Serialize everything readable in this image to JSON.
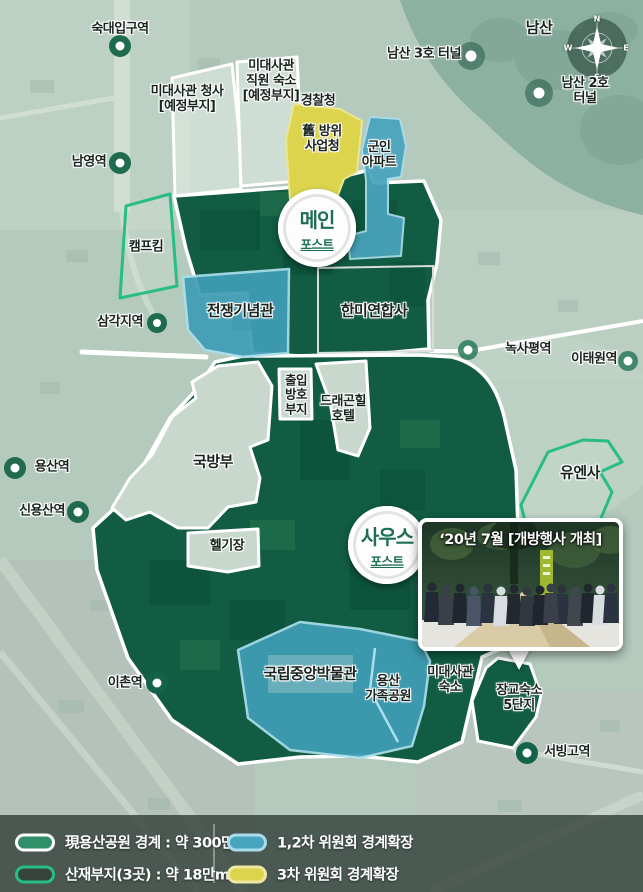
{
  "compass": {
    "n": "N",
    "e": "E",
    "s": "S",
    "w": "W"
  },
  "badges": {
    "main_line1": "메인",
    "main_line2": "포스트",
    "south_line1": "사우스",
    "south_line2": "포스트"
  },
  "stations": {
    "sookdae": "숙대입구역",
    "namyeong": "남영역",
    "samgakji": "삼각지역",
    "noksapyeong": "녹사평역",
    "itaewon": "이태원역",
    "yongsan": "용산역",
    "sinyongsan": "신용산역",
    "ichon": "이촌역",
    "seobinggo": "서빙고역"
  },
  "landmarks": {
    "namsan": "남산",
    "tunnel3": "남산 3호 터널",
    "tunnel2": "남산 2호 터널",
    "embassy_office": "미대사관 청사\n[예정부지]",
    "embassy_staff": "미대사관\n직원 숙소\n[예정부지]",
    "police": "경찰청",
    "old_dapa": "舊 방위\n사업청",
    "military_apt": "군인\n아파트",
    "camp_kim": "캠프킴",
    "war_memorial": "전쟁기념관",
    "cfc": "한미연합사",
    "access_site": "출입\n방호\n부지",
    "dragon_hill": "드래곤힐\n호텔",
    "mnd": "국방부",
    "heliport": "헬기장",
    "un_command": "유엔사",
    "museum": "국립중앙박물관",
    "family_park": "용산\n가족공원",
    "embassy_housing": "미대사관\n숙소",
    "officer_housing": "장교숙소\n5단지"
  },
  "photo": {
    "caption": "‘20년 7월 [개방행사 개최]"
  },
  "legend": {
    "items": [
      {
        "label": "現용산공원 경계 : 약 300만m²"
      },
      {
        "label": "산재부지(3곳) : 약 18만m²"
      },
      {
        "label": "1,2차 위원회 경계확장"
      },
      {
        "label": "3차 위원회 경계확장"
      }
    ]
  },
  "colors": {
    "park_green": "#115c42",
    "expansion_teal": "#49a4bd",
    "expansion_yellow": "#dcd44d",
    "scattered_outline": "#27bd84"
  }
}
